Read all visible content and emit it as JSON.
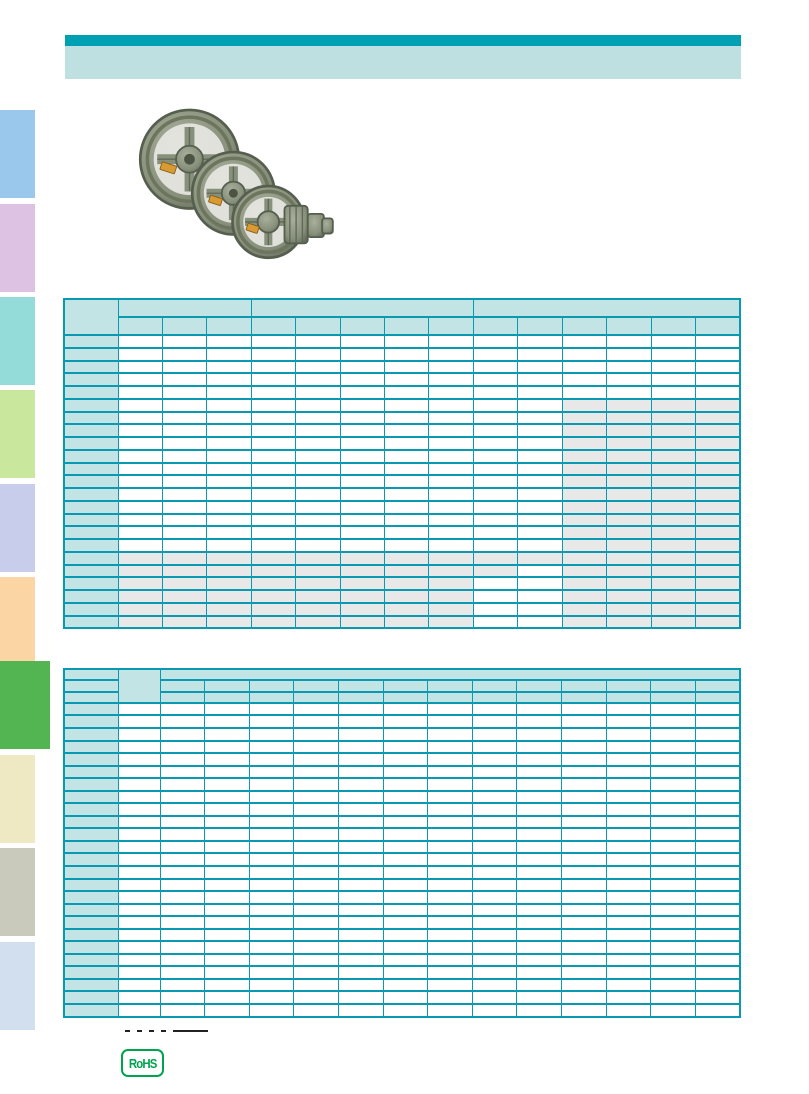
{
  "page": {
    "width": 809,
    "height": 1094,
    "background": "#ffffff"
  },
  "header": {
    "title_bar_color": "#00a0b4",
    "subtitle_bar_color": "#bfe0e0",
    "title_text": "",
    "subtitle_text": ""
  },
  "sidebar": {
    "tabs": [
      {
        "id": "tab-1",
        "color": "#9ac7ec",
        "active": false
      },
      {
        "id": "tab-2",
        "color": "#ddc2e4",
        "active": false
      },
      {
        "id": "tab-3",
        "color": "#93dcda",
        "active": false
      },
      {
        "id": "tab-4",
        "color": "#c9e79d",
        "active": false
      },
      {
        "id": "tab-5",
        "color": "#c9cdec",
        "active": false
      },
      {
        "id": "tab-6",
        "color": "#fbd6a4",
        "active": false
      },
      {
        "id": "tab-7",
        "color": "#52b551",
        "active": true
      },
      {
        "id": "tab-8",
        "color": "#eee9c2",
        "active": false
      },
      {
        "id": "tab-9",
        "color": "#c9cabb",
        "active": false
      },
      {
        "id": "tab-10",
        "color": "#d2dfee",
        "active": false
      }
    ]
  },
  "product": {
    "image_name": "v-belt-pulleys-photo",
    "description": "three overlapping cast-iron spoked v-belt pulleys with stepped boss",
    "body_color": "#87907b",
    "shade_color": "#656e5c",
    "tag_color": "#d89a33"
  },
  "table1": {
    "style": {
      "border": "#0999b1",
      "header_fill": "#c2e4e4",
      "shaded_fill": "#e8e8e8",
      "cell_fill": "#ffffff"
    },
    "corner_diagonal": true,
    "column_groups": [
      3,
      5,
      6
    ],
    "columns": 14,
    "rows": 23,
    "row_header_width": 54,
    "cells_text": "",
    "shaded_ranges": [
      [
        6,
        23,
        11,
        14
      ],
      [
        18,
        23,
        1,
        8
      ],
      [
        18,
        19,
        9,
        9
      ],
      [
        18,
        18,
        10,
        10
      ]
    ]
  },
  "table2": {
    "style": {
      "border": "#0999b1",
      "header_fill": "#c2e4e4",
      "shaded_fill": "#e8e8e8",
      "cell_fill": "#ffffff"
    },
    "header_rows": 3,
    "columns": 13,
    "rows": 25,
    "row_header_width": 54,
    "second_column_width": 42,
    "cells_text": "",
    "shaded_ranges": []
  },
  "footer": {
    "footnote_dash_count": 4,
    "rohs_label": "RoHS",
    "rohs_color": "#00a44e"
  }
}
